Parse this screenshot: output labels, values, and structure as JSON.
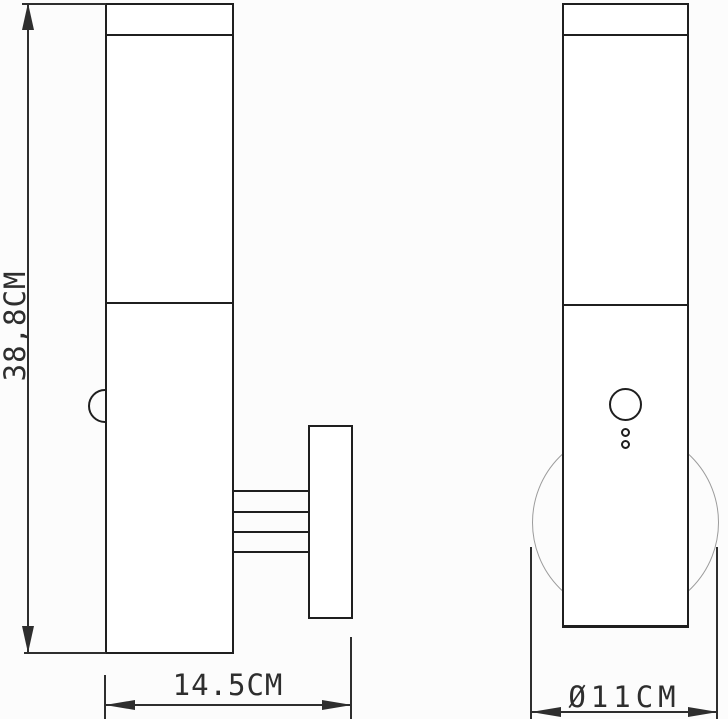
{
  "labels": {
    "height": "38,8CM",
    "depth": "14.5CM",
    "diameter": "Ø11CM"
  },
  "colors": {
    "line": "#1f1f1f",
    "dim": "#2e2e2e",
    "circle_light": "#9c9c9c",
    "bg": "#fcfcfc",
    "text": "#2e2e2e"
  }
}
